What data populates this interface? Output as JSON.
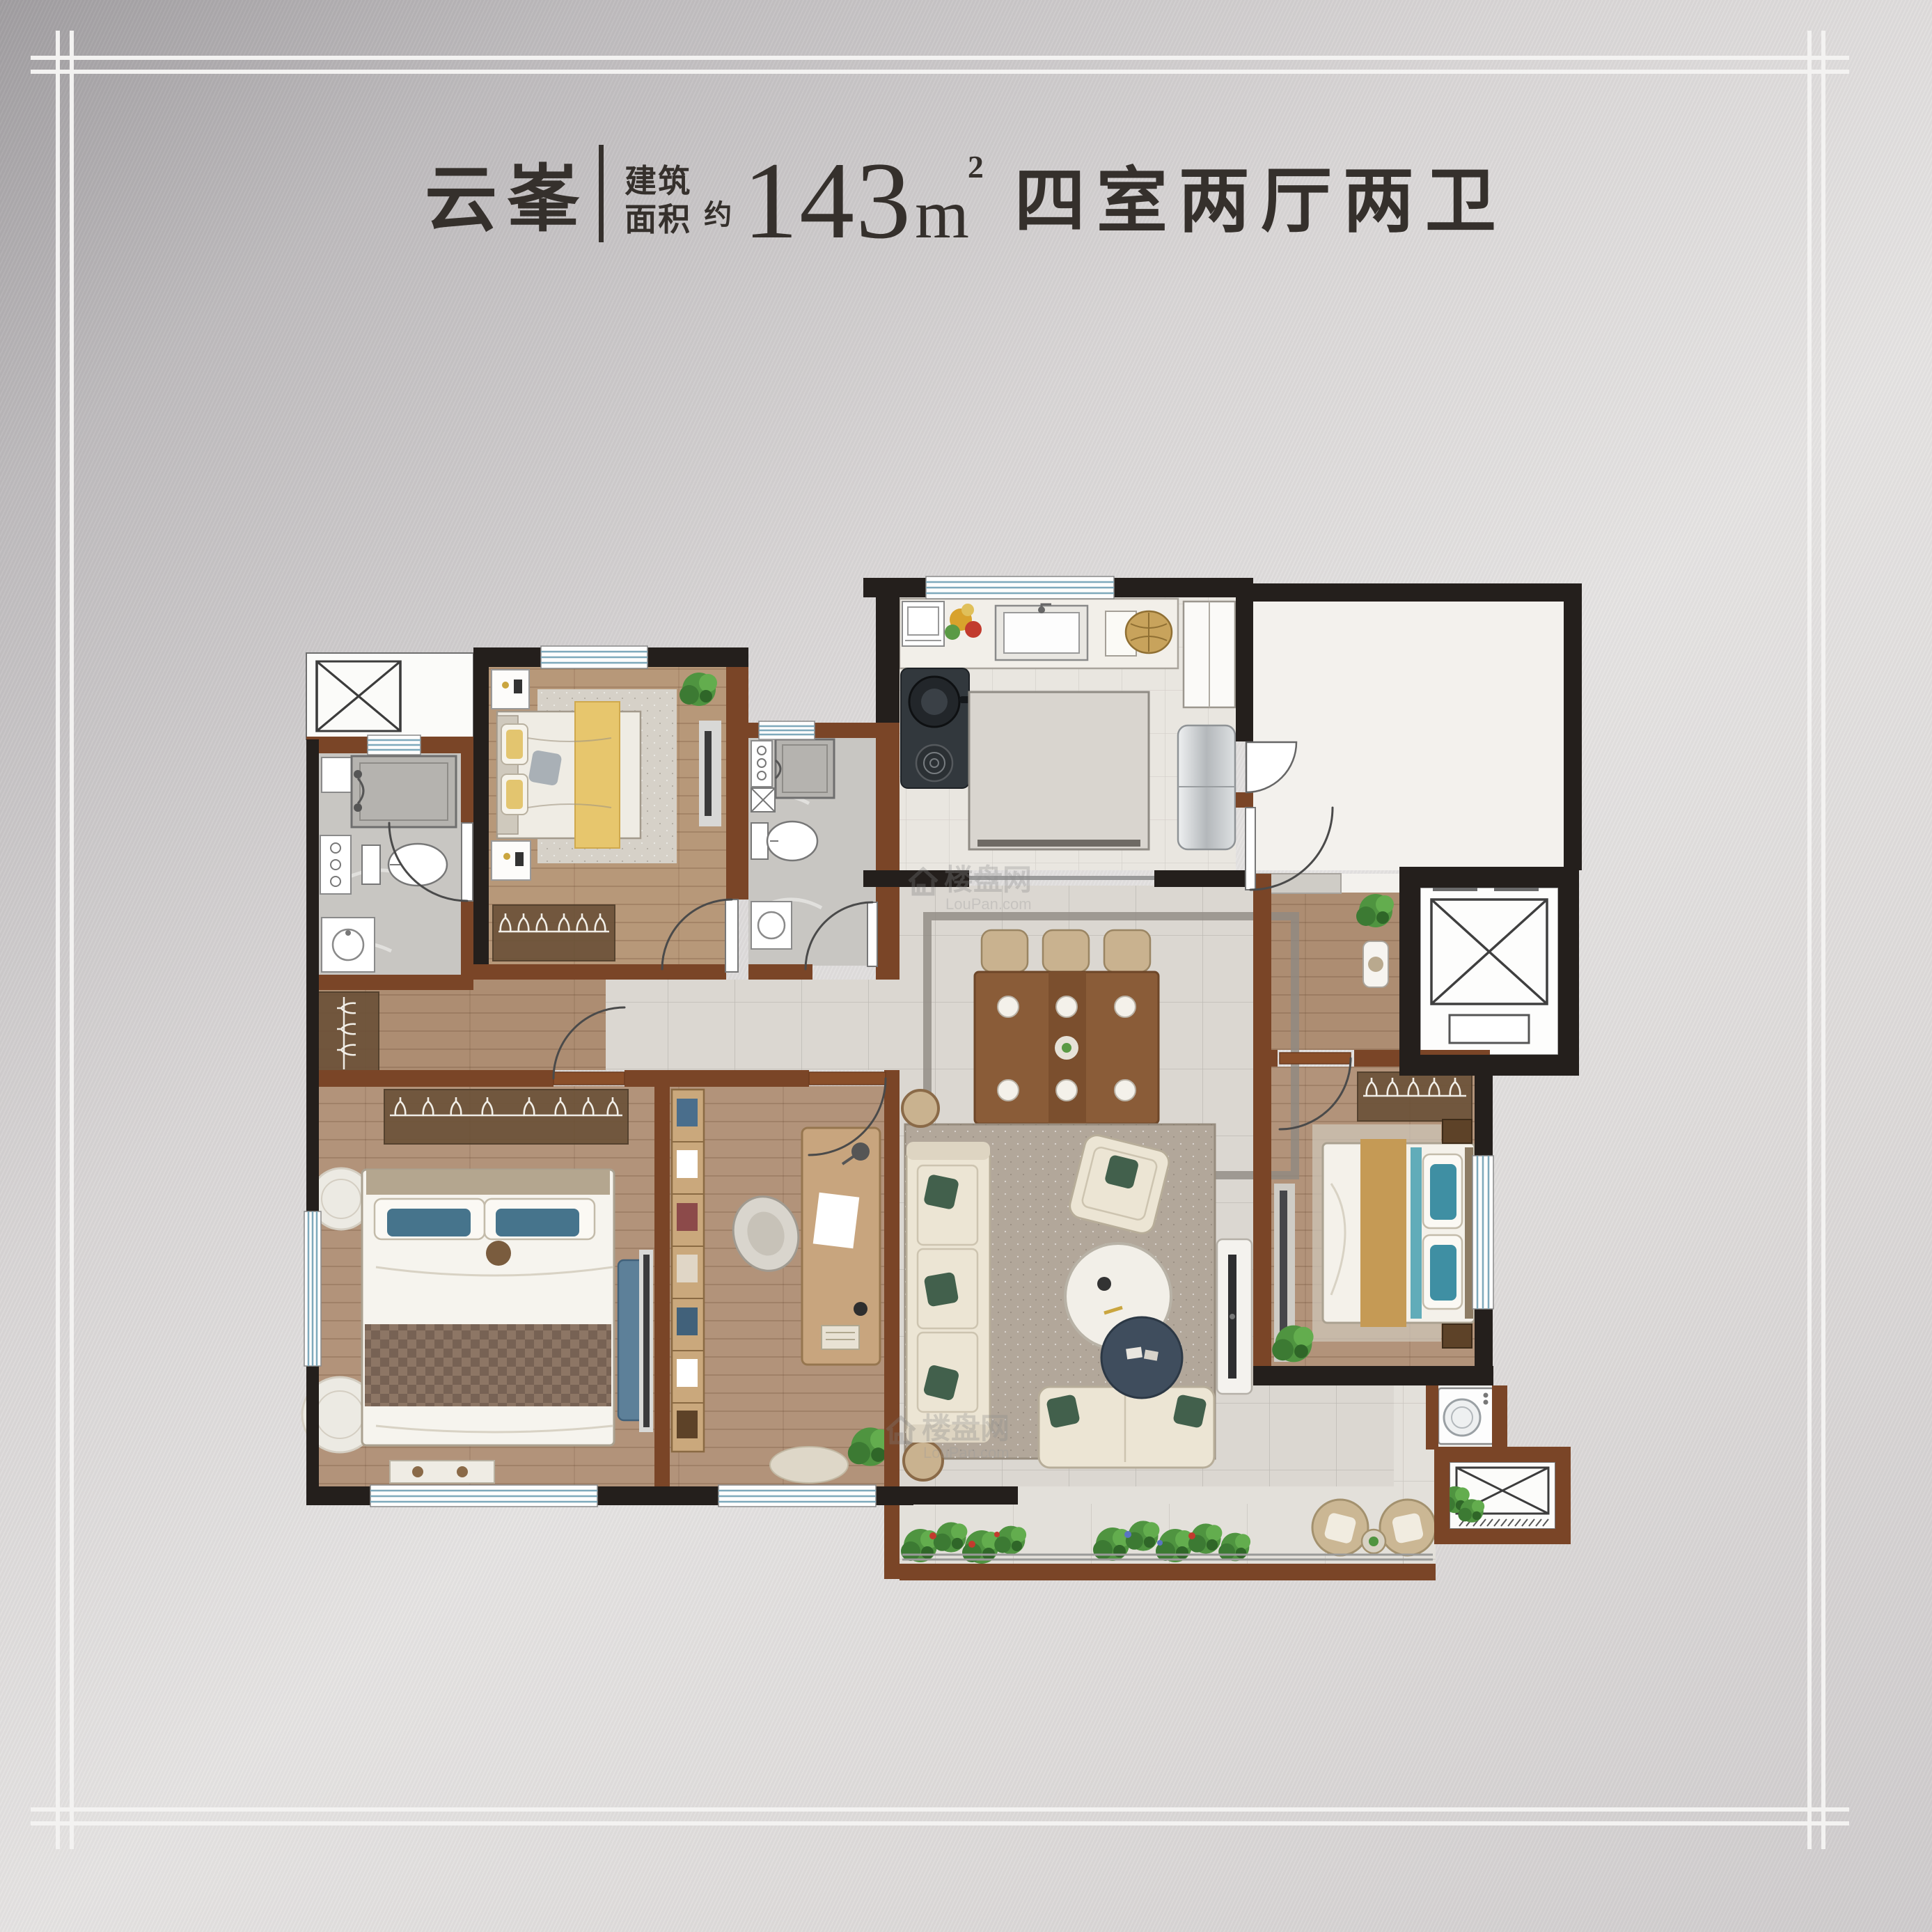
{
  "page": {
    "type": "real-estate-floor-plan-poster"
  },
  "title": {
    "project_name": "云峯",
    "area_label_line1": "建筑",
    "area_label_line2": "面积",
    "area_prefix": "约",
    "area_value": "143",
    "area_unit_base": "m",
    "area_unit_exponent": "2",
    "layout_spec": "四室两厅两卫"
  },
  "watermark": {
    "site_name": "楼盘网",
    "site_domain": "LouPan.com"
  },
  "colors": {
    "background_dark": "#a09da0",
    "background_light": "#e6e4e3",
    "frame_line": "#f3f2f1",
    "title_text": "#35302c",
    "wall_structural": "#241f1c",
    "wall_partition": "#7a4527",
    "floor_wood": "#b2937a",
    "floor_tile": "#dbd7d1",
    "floor_bath": "#c8c6c2",
    "window_glass": "#7ea9bc",
    "bed_yellow": "#e7c66d",
    "bed_blue": "#46748c",
    "bed_teal": "#3f8fa3",
    "sofa_cream": "#ece5d4",
    "pillow_green": "#42604c",
    "dining_wood": "#8a5c38",
    "rug_living": "#b2a79a",
    "plant_green": "#4f9440",
    "fridge_silver": "#c3c6c9"
  },
  "floor_plan": {
    "icons": [
      "elevator-x-icon",
      "equipment-platform-x-icon",
      "washing-machine-icon",
      "toilet-icon",
      "sink-icon",
      "shower-counter-icon",
      "stove-icon",
      "kitchen-sink-icon",
      "fridge-icon",
      "island-counter-icon",
      "dining-table-icon",
      "dining-chair-icon",
      "sofa-icon",
      "armchair-icon",
      "loveseat-icon",
      "coffee-table-icon",
      "tv-icon",
      "bed-icon",
      "nightstand-icon",
      "wardrobe-hangers-icon",
      "bookshelf-icon",
      "desk-icon",
      "office-chair-icon",
      "plant-icon",
      "balcony-chair-icon",
      "door-swing-icon",
      "window-band",
      "watermark-house-icon"
    ]
  }
}
